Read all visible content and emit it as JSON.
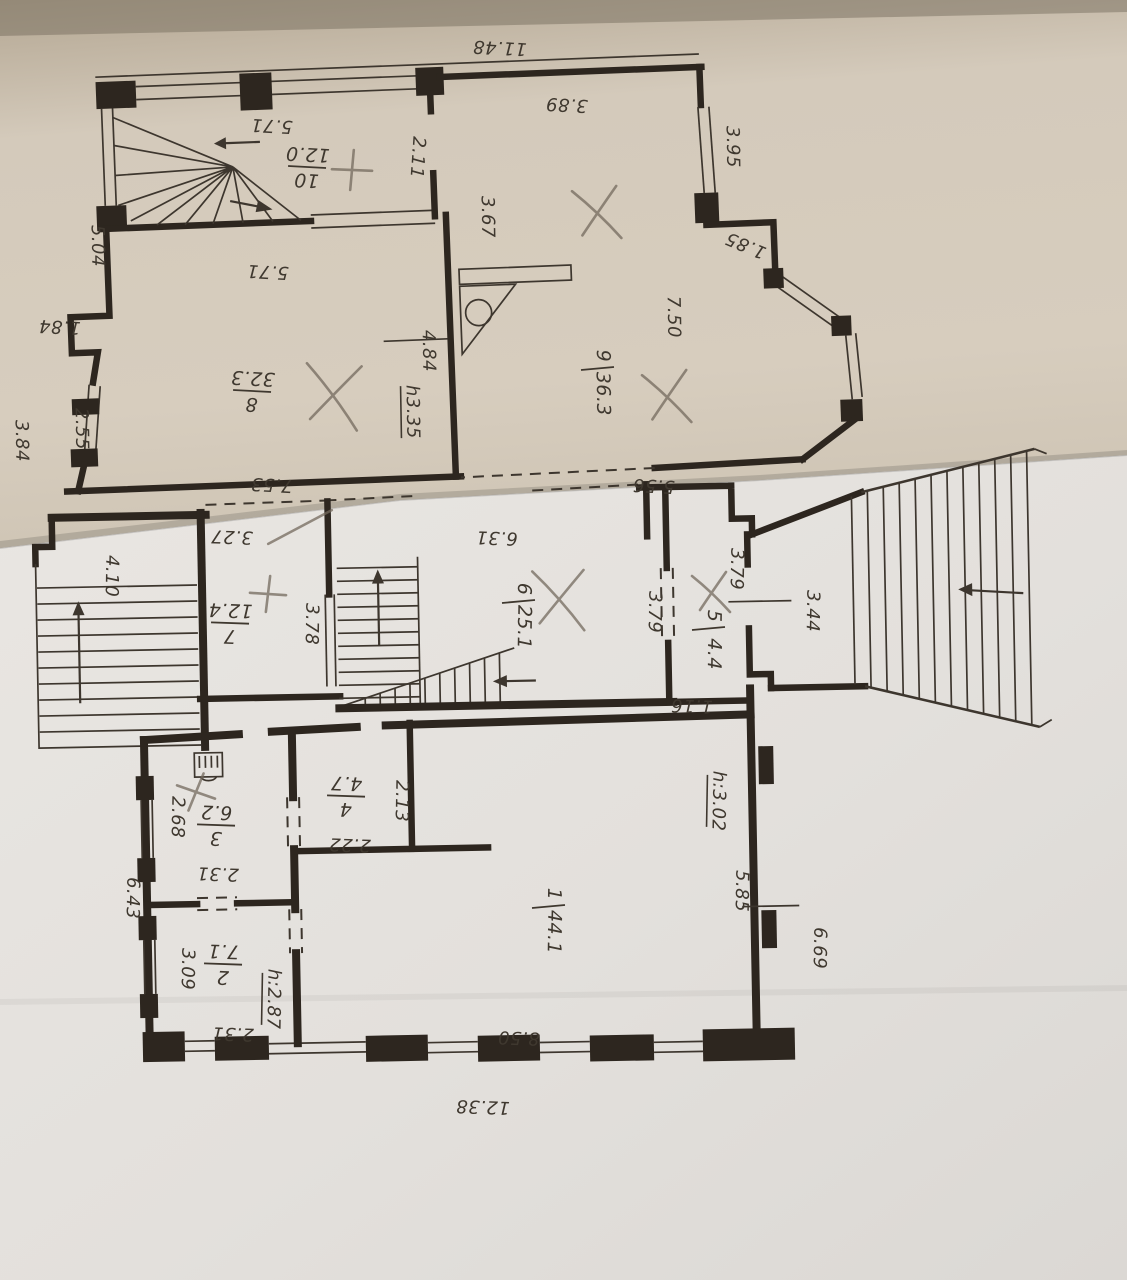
{
  "document": {
    "kind": "scanned floor plan, two overlapping paper sheets",
    "sheet_upper": "upper floor plan (beige sheet, drawn upside down)",
    "sheet_lower": "ground floor plan (white sheet, drawn upside down)"
  },
  "palette": {
    "paper_upper": "#d2c8b8",
    "paper_lower": "#e7e4e0",
    "ink": "#2d261f",
    "pencil": "#746a5e",
    "backdrop": "#8f887c"
  },
  "rooms": [
    {
      "floor": "upper",
      "num": "10",
      "area": "12.0",
      "x": 307,
      "y": 168,
      "r": 183
    },
    {
      "floor": "upper",
      "num": "8",
      "area": "32.3",
      "x": 252,
      "y": 392,
      "r": 183
    },
    {
      "floor": "upper",
      "num": "9",
      "area": "36.3",
      "x": 597,
      "y": 368,
      "r": 89,
      "v": true
    },
    {
      "floor": "ground",
      "num": "7",
      "area": "12.4",
      "x": 230,
      "y": 624,
      "r": 182
    },
    {
      "floor": "ground",
      "num": "6",
      "area": "25.1",
      "x": 518,
      "y": 601,
      "r": 91,
      "v": true
    },
    {
      "floor": "ground",
      "num": "5",
      "area": "4.4",
      "x": 708,
      "y": 628,
      "r": 91,
      "v": true
    },
    {
      "floor": "ground",
      "num": "4",
      "area": "4.7",
      "x": 346,
      "y": 797,
      "r": 182
    },
    {
      "floor": "ground",
      "num": "3",
      "area": "6.2",
      "x": 216,
      "y": 826,
      "r": 182
    },
    {
      "floor": "ground",
      "num": "2",
      "area": "7.1",
      "x": 223,
      "y": 965,
      "r": 182
    },
    {
      "floor": "ground",
      "num": "1",
      "area": "44.1",
      "x": 548,
      "y": 906,
      "r": 91,
      "v": true
    }
  ],
  "dimensions": [
    {
      "t": "11.48",
      "x": 500,
      "y": 42,
      "r": 183
    },
    {
      "t": "5.71",
      "x": 272,
      "y": 120,
      "r": 183
    },
    {
      "t": "5.71",
      "x": 268,
      "y": 266,
      "r": 183
    },
    {
      "t": "2.11",
      "x": 412,
      "y": 157,
      "r": 94
    },
    {
      "t": "3.89",
      "x": 567,
      "y": 99,
      "r": 183
    },
    {
      "t": "3.95",
      "x": 727,
      "y": 147,
      "r": 89
    },
    {
      "t": "1.85",
      "x": 748,
      "y": 240,
      "r": 203
    },
    {
      "t": "7.50",
      "x": 668,
      "y": 317,
      "r": 89
    },
    {
      "t": "3.67",
      "x": 482,
      "y": 217,
      "r": 89
    },
    {
      "t": "5.04",
      "x": 92,
      "y": 246,
      "r": 89
    },
    {
      "t": "1.84",
      "x": 60,
      "y": 321,
      "r": 183
    },
    {
      "t": "3.84",
      "x": 16,
      "y": 441,
      "r": 89
    },
    {
      "t": "2.55",
      "x": 76,
      "y": 429,
      "r": 89
    },
    {
      "t": "7.53",
      "x": 272,
      "y": 479,
      "r": 183
    },
    {
      "t": "5.56",
      "x": 654,
      "y": 480,
      "r": 183
    },
    {
      "t": "4.84",
      "x": 423,
      "y": 351,
      "r": 89
    },
    {
      "t": "h3.35",
      "x": 407,
      "y": 412,
      "r": 89,
      "u": true
    },
    {
      "t": "3.27",
      "x": 232,
      "y": 531,
      "r": 182
    },
    {
      "t": "6.31",
      "x": 497,
      "y": 532,
      "r": 182
    },
    {
      "t": "4.10",
      "x": 106,
      "y": 576,
      "r": 91
    },
    {
      "t": "3.78",
      "x": 306,
      "y": 624,
      "r": 91
    },
    {
      "t": "3.79",
      "x": 649,
      "y": 612,
      "r": 91
    },
    {
      "t": "3.79",
      "x": 731,
      "y": 569,
      "r": 91
    },
    {
      "t": "3.44",
      "x": 807,
      "y": 611,
      "r": 91
    },
    {
      "t": "1.16",
      "x": 692,
      "y": 700,
      "r": 182
    },
    {
      "t": "2.68",
      "x": 172,
      "y": 817,
      "r": 91
    },
    {
      "t": "2.31",
      "x": 218,
      "y": 868,
      "r": 182
    },
    {
      "t": "2.22",
      "x": 350,
      "y": 839,
      "r": 182
    },
    {
      "t": "2.13",
      "x": 396,
      "y": 801,
      "r": 91
    },
    {
      "t": "3.09",
      "x": 182,
      "y": 969,
      "r": 91
    },
    {
      "t": "h:2.87",
      "x": 268,
      "y": 999,
      "r": 91,
      "u": true
    },
    {
      "t": "2.31",
      "x": 233,
      "y": 1028,
      "r": 182
    },
    {
      "t": "6.43",
      "x": 127,
      "y": 898,
      "r": 91
    },
    {
      "t": "h:3.02",
      "x": 713,
      "y": 801,
      "r": 91,
      "u": true
    },
    {
      "t": "5.85",
      "x": 736,
      "y": 891,
      "r": 91
    },
    {
      "t": "6.69",
      "x": 814,
      "y": 948,
      "r": 91
    },
    {
      "t": "8.50",
      "x": 519,
      "y": 1032,
      "r": 182
    },
    {
      "t": "12.38",
      "x": 483,
      "y": 1101,
      "r": 182
    }
  ],
  "pencil_marks": [
    {
      "type": "plus",
      "x": 352,
      "y": 170,
      "s": 20,
      "a": 8
    },
    {
      "type": "x",
      "x": 598,
      "y": 212,
      "s": 26,
      "a": 0
    },
    {
      "type": "x",
      "x": 334,
      "y": 394,
      "s": 32,
      "a": 10
    },
    {
      "type": "slash",
      "x": 300,
      "y": 527,
      "s": 36,
      "a": 62
    },
    {
      "type": "x",
      "x": 668,
      "y": 396,
      "s": 26,
      "a": 0
    },
    {
      "type": "plus",
      "x": 268,
      "y": 594,
      "s": 18,
      "a": 10
    },
    {
      "type": "x",
      "x": 560,
      "y": 598,
      "s": 30,
      "a": 5
    },
    {
      "type": "x",
      "x": 712,
      "y": 592,
      "s": 20,
      "a": 0
    },
    {
      "type": "plus",
      "x": 196,
      "y": 792,
      "s": 20,
      "a": 25
    }
  ]
}
